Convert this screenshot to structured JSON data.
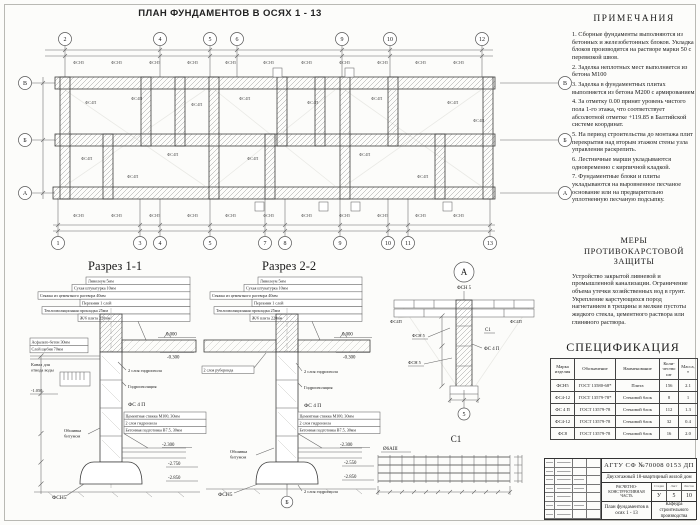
{
  "sheet": {
    "title": "ПЛАН ФУНДАМЕНТОВ В ОСЯХ 1 - 13"
  },
  "plan": {
    "axes_top": [
      "2",
      "4",
      "5",
      "6",
      "9",
      "10",
      "12"
    ],
    "axes_bottom": [
      "1",
      "3",
      "4",
      "5",
      "7",
      "8",
      "9",
      "10",
      "11",
      "13"
    ],
    "axes_left": [
      "В",
      "Б",
      "А"
    ],
    "axes_right": [
      "В",
      "Б",
      "А"
    ],
    "block_label": "ФС4П",
    "slab_label": "ФСН5"
  },
  "sections": {
    "floor_layers": [
      "Линолеум 5мм",
      "Сухая штукатурка 10мм",
      "Стяжка из цементного раствора 40мм",
      "Пергамин 1 слой",
      "Теплоизоляционная прокладка 25мм",
      "Ж/б плита 220мм"
    ],
    "base_layers": [
      "Цементная стяжка М100, 30мм",
      "2 слоя гидроизола",
      "Бетонная подготовка В7.5, 30мм"
    ],
    "hydro2": "2 слоя гидроизола",
    "hydro": "Гидроизоляция",
    "wall_block": "ФС 4 П",
    "footing": "ФСН5",
    "bitum_line1": "Обшивка",
    "bitum_line2": "битумом"
  },
  "section1": {
    "title": "Разрез 1-1",
    "asphalt": "Асфальто-бетон 30мм",
    "gravel": "Слой щебня 70мм",
    "canal_line1": "Канал для",
    "canal_line2": "отвода воды",
    "elev": [
      "0.000",
      "-0.300",
      "-1.050",
      "-2.300",
      "-2.750",
      "-2.850"
    ]
  },
  "section2": {
    "title": "Разрез 2-2",
    "ruberoid": "2 слоя рубероида",
    "elev": [
      "0.000",
      "-0.300",
      "-2.300",
      "-2.550",
      "-2.850"
    ],
    "axis": "Б"
  },
  "detail_a": {
    "title": "А",
    "slab_top": "ФСН 5",
    "left_block": "ФС4П",
    "right_block": "ФС4П",
    "mesh": "С1",
    "slab2": "ФСН 5",
    "wall": "ФС 4 П",
    "slab3": "ФСН 5",
    "axis": "5"
  },
  "detail_c1": {
    "title": "С1",
    "rebar": "Ø6АIII"
  },
  "notes": {
    "title": "ПРИМЕЧАНИЯ",
    "items": [
      "1. Сборные фундаменты выполняются из бетонных и железобетонных блоков. Укладка блоков производится на растворе марки 50 с перевязкой швов.",
      "2. Заделка неплотных мест выполняется из бетона М100",
      "3. Заделка в фундаментных плитах выполняется из бетона М200 с армированием",
      "4. За отметку 0.00 принят уровень чистого пола 1-го этажа, что соответствует абсолютной отметке +119.85 в Балтийской системе координат.",
      "5. На период строительства до монтажа плит перекрытия над вторым этажом стены узла управления раскрепить.",
      "6. Лестничные марши укладываются одновременно с кирпичной кладкой.",
      "7. Фундаментные блоки и плиты укладываются на выровненное песчаное основание или на предварительно уплотненную песчаную подсыпку."
    ]
  },
  "karst": {
    "title": "МЕРЫ ПРОТИВОКАРСТОВОЙ ЗАЩИТЫ",
    "text": "Устройство закрытой ливневой и промышленной канализации. Ограничение объема утечки хозяйственных вод в грунт. Укрепление карстующихся пород нагнетанием в трещины и мелкие пустоты жидкого стекла, цементного раствора или глиняного раствора."
  },
  "spec": {
    "title": "СПЕЦИФИКАЦИЯ",
    "headers": [
      "Марка изделия",
      "Обозначение",
      "Наименование",
      "Коли-чество шт",
      "Масса, т"
    ],
    "rows": [
      [
        "ФСН5",
        "ГОСТ 13580-68*",
        "Плита",
        "156",
        "2.1"
      ],
      [
        "ФС4-12",
        "ГОСТ 13579-78*",
        "Стеновой блок",
        "8",
        "1"
      ],
      [
        "ФС 4 П",
        "ГОСТ 13579-78",
        "Стеновой блок",
        "112",
        "1.3"
      ],
      [
        "ФС4-12",
        "ГОСТ 13579-78",
        "Стеновой блок",
        "32",
        "0.4"
      ],
      [
        "ФС8",
        "ГОСТ 13579-78",
        "Стеновой блок",
        "16",
        "2.0"
      ]
    ]
  },
  "titleblock": {
    "doc_number": "АГТУ СФ №70008 0153 ДП",
    "project": "Двухэтажный 18-квартирный жилой дом",
    "part": "РАСЧЕТНО-КОНСТРУКТИВНАЯ ЧАСТЬ",
    "stage_headers": [
      "Стадия",
      "Лист",
      "Листов"
    ],
    "stage": "У",
    "sheet": "5",
    "sheets": "10",
    "drawing_name": "План фундаментов в осях 1 - 13",
    "department": "Кафедра строительного производства"
  }
}
